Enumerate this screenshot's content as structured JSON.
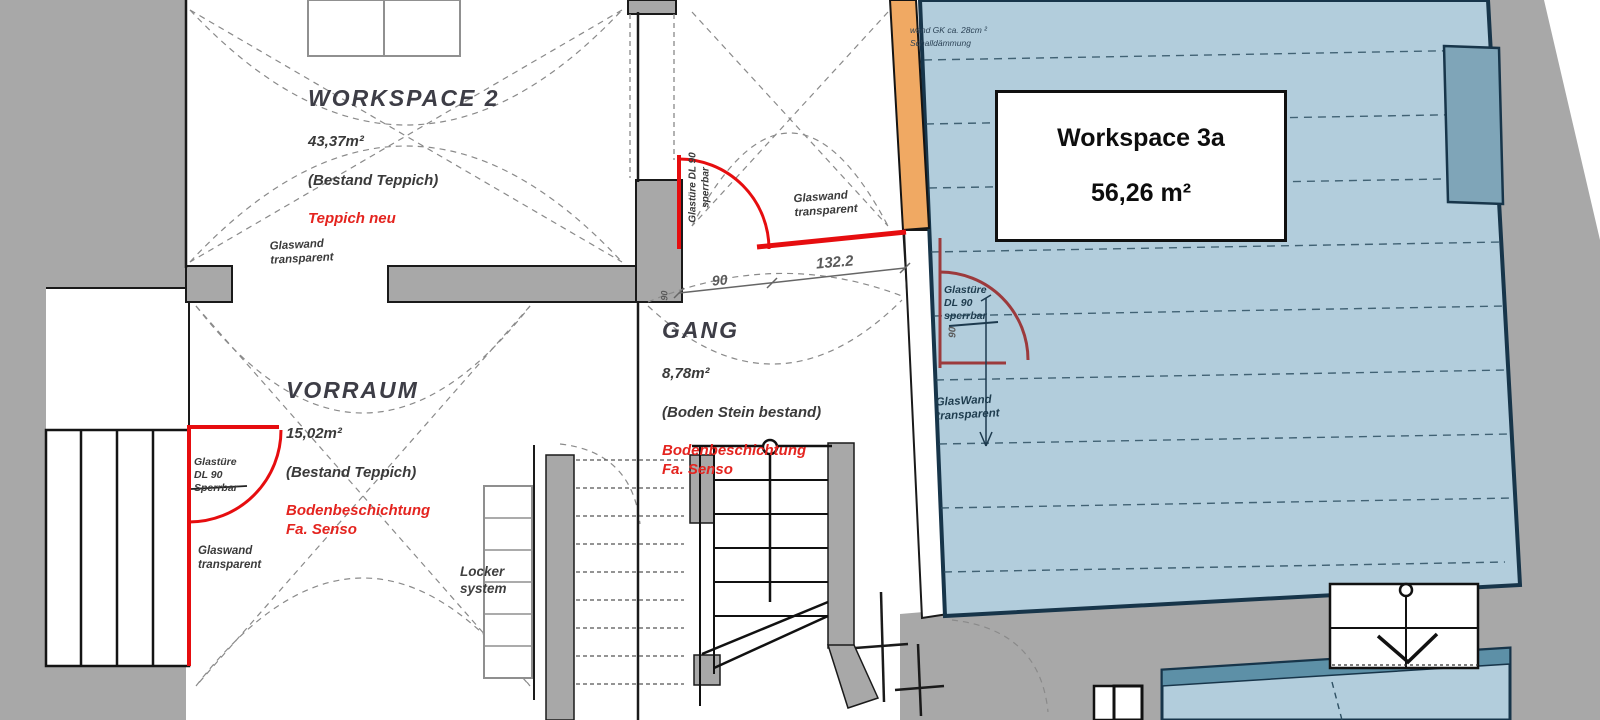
{
  "plan": {
    "rooms": {
      "workspace2": {
        "name": "WORKSPACE 2",
        "area": "43,37m²",
        "floor_existing": "(Bestand Teppich)",
        "floor_new": "Teppich neu"
      },
      "vorraum": {
        "name": "VORRAUM",
        "area": "15,02m²",
        "floor_existing": "(Bestand Teppich)",
        "floor_new": "Bodenbeschichtung\nFa. Senso"
      },
      "gang": {
        "name": "GANG",
        "area": "8,78m²",
        "floor_existing": "(Boden Stein bestand)",
        "floor_new": "Bodenbeschichtung\nFa. Senso"
      },
      "workspace3a": {
        "name": "Workspace 3a",
        "area": "56,26 m²"
      }
    },
    "annotations": {
      "glaswand_workspace2": "Glaswand\ntransparent",
      "glaswand_gang": "Glaswand\ntransparent",
      "glaswand_vorraum": "Glaswand\ntransparent",
      "glaswand_workspace3a": "GlasWand\ntransparent",
      "glastuere_vorraum": "Glastüre\nDL 90\nSperrbar",
      "glastuere_gang": "Glastüre DL 90\nsperrbar",
      "glastuere_workspace3a": "Glastüre\nDL 90\nsperrbar",
      "wall_note": "wand GK ca. 28cm ²\nSchalldämmung",
      "locker": "Locker\nsystem"
    },
    "dimensions": {
      "door_clear_90": "90",
      "wall_132_2": "132.2",
      "door_swing_gang_90": "90",
      "door_swing_ws3a_90": "90"
    },
    "colors": {
      "wall_gray": "#a8a8a8",
      "glass_red": "#e60d0f",
      "workspace3a_blue": "#b2cddc",
      "navy_border": "#17354a",
      "notch_blue": "#7fa5b8",
      "teal_band": "#5d90a7",
      "orange_wall": "#f0a963",
      "maroon_door": "#9c3a3c",
      "new_floor_red": "#e4241f"
    }
  }
}
